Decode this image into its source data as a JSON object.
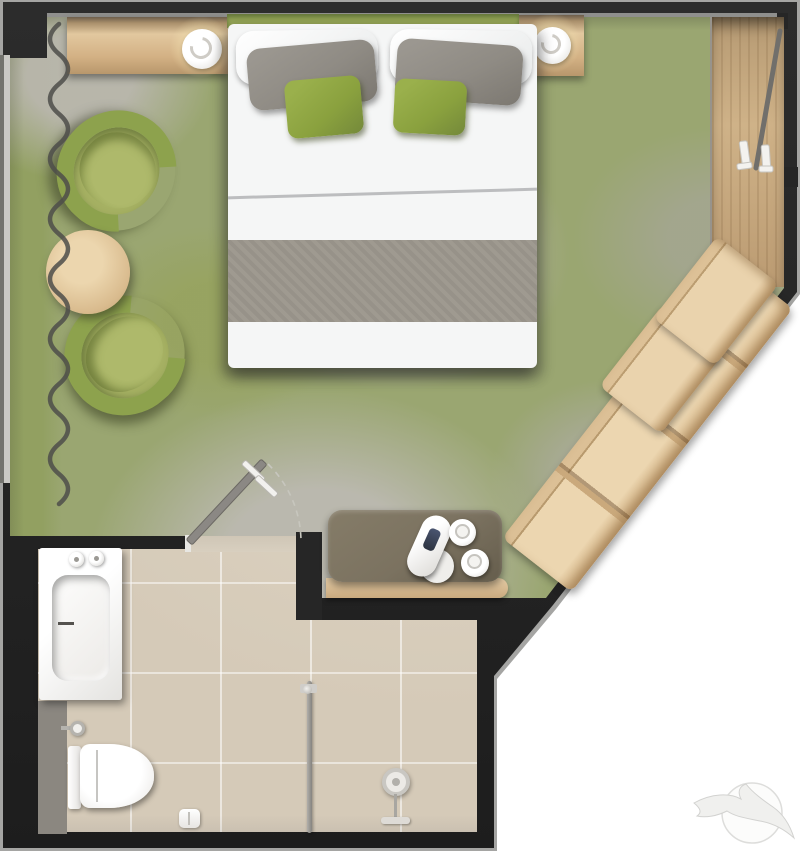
{
  "scene": {
    "kind": "hotel-room-floor-plan",
    "view": "top-down 3d render, no text labels",
    "bedroom": {
      "floor": "mottled green and gray carpet",
      "items": [
        "console with table lamp",
        "nightstand with table lamp",
        "double bed with green headboard, two white pillows, two gray pillows, two green cushions, gray runner",
        "lounge armchair upper",
        "lounge armchair lower",
        "round wooden coffee table",
        "wavy curtain along window wall",
        "open wardrobe with clothes rail and two hangers",
        "diagonal open shelving unit",
        "minibar desk with kettle and two cups",
        "door swinging open with dashed swing arc"
      ]
    },
    "bathroom": {
      "floor": "beige ceramic tile with grout grid",
      "items": [
        "bathtub with two taps and drain lever",
        "half wall panel",
        "wall-hung toilet with cistern",
        "water valve",
        "toilet paper roll",
        "shower rail",
        "handheld shower set"
      ]
    },
    "watermark": "light gray seagull flying across a sun circle, bottom right"
  },
  "colors": {
    "wall": "#262626",
    "wall-outline": "#a5a5a3",
    "carpet-green": "#9aa671",
    "tile": "#d5cab8",
    "bed-white": "#f5f6f6",
    "headboard": "#93a356",
    "runner": "#9c978d",
    "pillow-gray": "#8f8b84",
    "pillow-green": "#8aa13e",
    "chair": "#8da24d",
    "cushion": "#a6b163",
    "desk": "#7b7260",
    "door": "#8b8884",
    "curtain": "#4e4e4a",
    "chrome": "#909090",
    "glow": "#f6e7bf",
    "logo": "#ededeb"
  }
}
